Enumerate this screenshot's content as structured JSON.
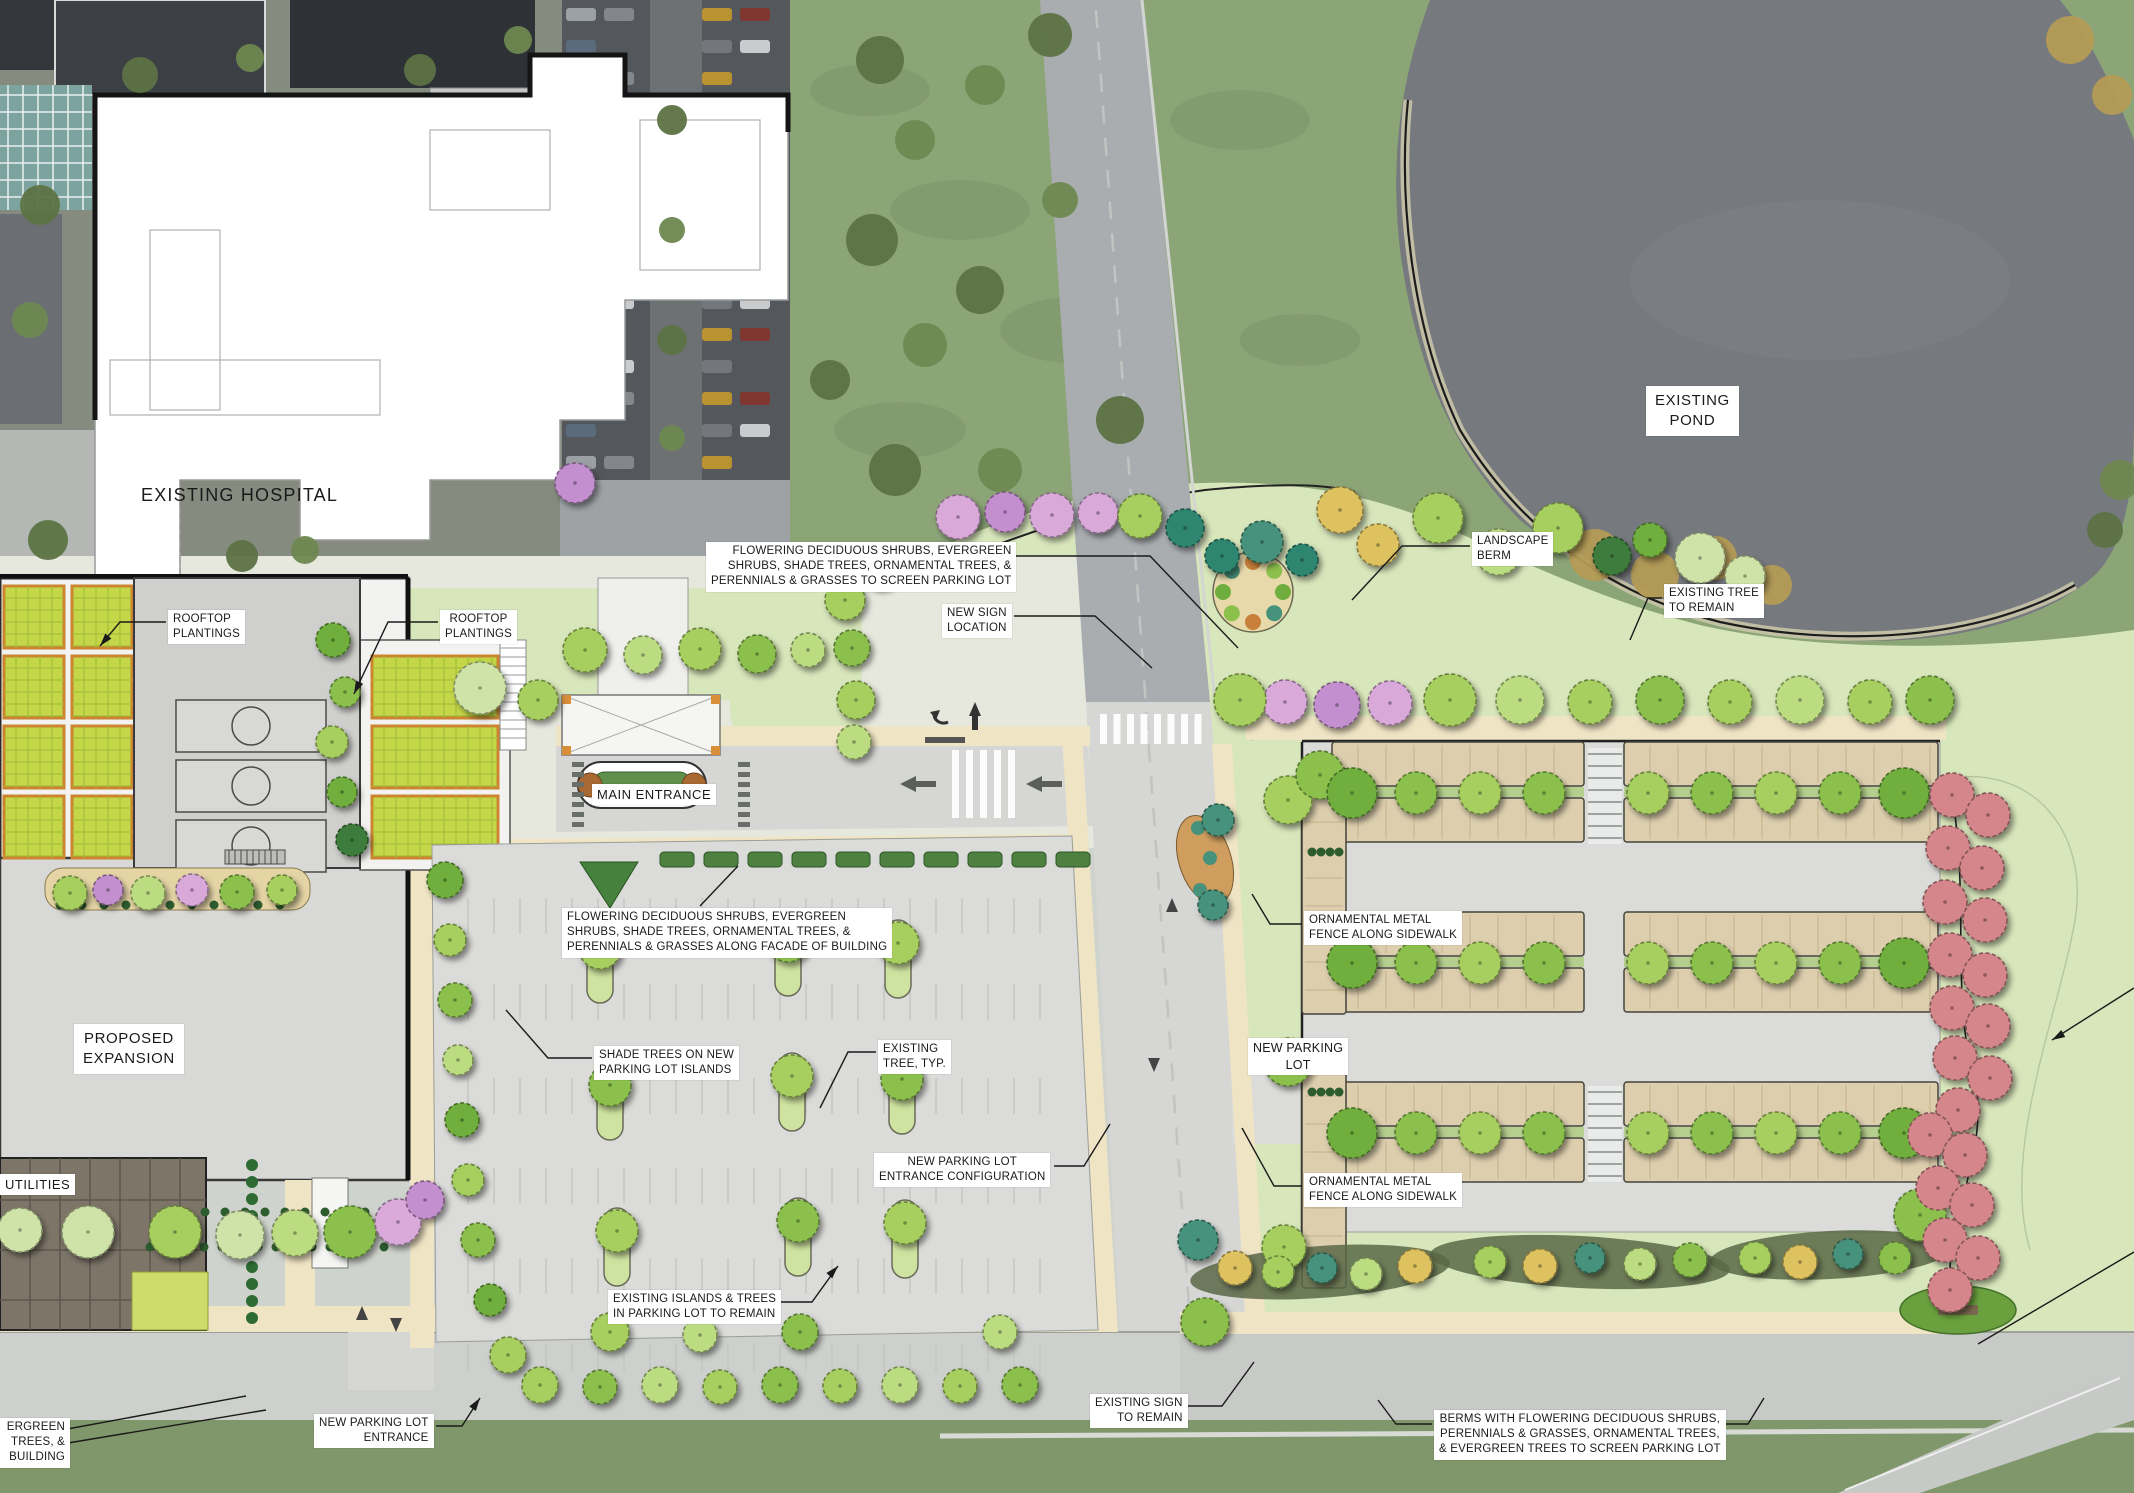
{
  "title": "Hospital Campus Landscape Site Plan",
  "palette": {
    "plan_lawn": "#d8e6bb",
    "aerial_lawn": "#8ca577",
    "pond_water": "#76797e",
    "parking_plan_gray": "#dbdcd9",
    "parking_bay_tan": "#ddcfae",
    "sidewalk_cream": "#efe4c4",
    "building_gray": "#d8d8d6",
    "rooftop_planting_green": "#c3d748",
    "rooftop_planting_border": "#cd8430",
    "tree_green": "#a6cf5f",
    "tree_dark_green": "#3e7c3c",
    "tree_evergreen_teal": "#2f8671",
    "tree_pink": "#d9a9da",
    "tree_purple": "#c48fcf",
    "tree_yellow": "#ddc25f",
    "tree_red": "#d4868a",
    "annotation_text": "#1a1a1a",
    "annotation_bg": "#ffffff"
  },
  "labels": {
    "existing_hospital": "EXISTING HOSPITAL",
    "existing_pond": "EXISTING\nPOND",
    "rooftop_plantings_left": "ROOFTOP\nPLANTINGS",
    "rooftop_plantings_right": "ROOFTOP\nPLANTINGS",
    "screen_parking_note": "FLOWERING DECIDUOUS SHRUBS, EVERGREEN\nSHRUBS, SHADE TREES, ORNAMENTAL TREES, &\nPERENNIALS & GRASSES TO SCREEN PARKING LOT",
    "new_sign_location": "NEW SIGN\nLOCATION",
    "landscape_berm": "LANDSCAPE\nBERM",
    "existing_tree_to_remain": "EXISTING TREE\nTO REMAIN",
    "main_entrance": "MAIN ENTRANCE",
    "facade_planting_note": "FLOWERING DECIDUOUS SHRUBS, EVERGREEN\nSHRUBS, SHADE TREES, ORNAMENTAL TREES, &\nPERENNIALS & GRASSES ALONG FACADE OF BUILDING",
    "proposed_expansion": "PROPOSED\nEXPANSION",
    "shade_trees_note": "SHADE TREES ON NEW\nPARKING LOT ISLANDS",
    "existing_tree_typ": "EXISTING\nTREE, TYP.",
    "new_parking_lot": "NEW PARKING\nLOT",
    "ornamental_fence_north": "ORNAMENTAL METAL\nFENCE ALONG SIDEWALK",
    "ornamental_fence_south": "ORNAMENTAL METAL\nFENCE ALONG SIDEWALK",
    "entrance_configuration_note": "NEW PARKING LOT\nENTRANCE CONFIGURATION",
    "existing_islands_note": "EXISTING ISLANDS & TREES\nIN PARKING LOT TO REMAIN",
    "existing_sign_to_remain": "EXISTING SIGN\nTO REMAIN",
    "new_parking_lot_entrance": "NEW PARKING LOT\nENTRANCE",
    "berms_note": "BERMS WITH FLOWERING DECIDUOUS SHRUBS,\nPERENNIALS & GRASSES, ORNAMENTAL TREES,\n& EVERGREEN TREES TO SCREEN PARKING LOT",
    "utilities": "UTILITIES",
    "edge_note_fragment": "ERGREEN\nTREES, &\nBUILDING"
  }
}
